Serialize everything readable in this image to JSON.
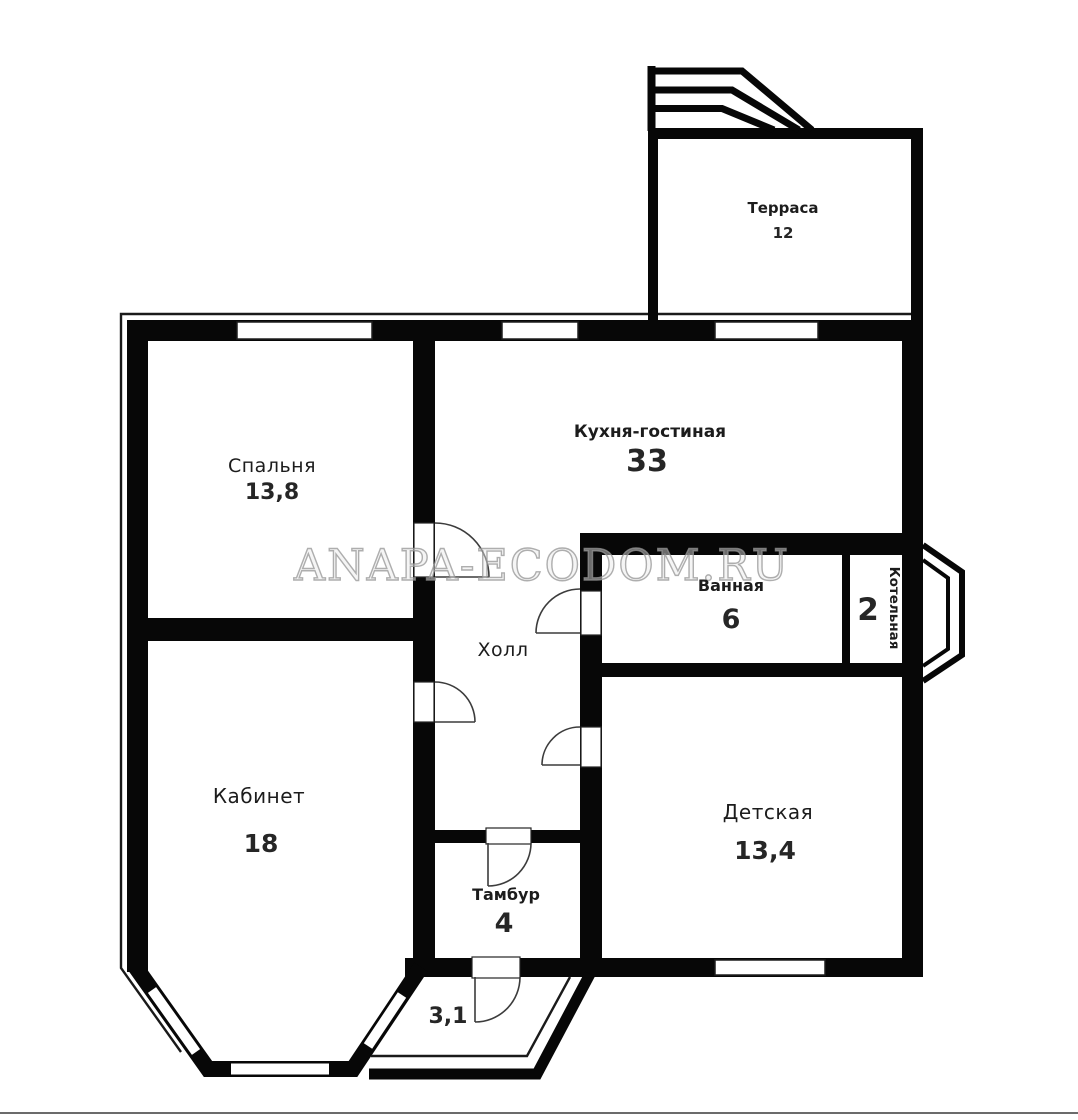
{
  "page": {
    "background": "#ffffff",
    "wall_color": "#070707",
    "watermark": "ANAPA-ECODOM.RU"
  },
  "rooms": {
    "terrace": {
      "name": "Терраса",
      "area": "12"
    },
    "bedroom": {
      "name": "Спальня",
      "area": "13,8"
    },
    "kitchen_living": {
      "name": "Кухня-гостиная",
      "area": "33"
    },
    "bathroom": {
      "name": "Ванная",
      "area": "6"
    },
    "boiler": {
      "name": "Котельная",
      "area": "2"
    },
    "hall": {
      "name": "Холл"
    },
    "office": {
      "name": "Кабинет",
      "area": "18"
    },
    "children": {
      "name": "Детская",
      "area": "13,4"
    },
    "vestibule": {
      "name": "Тамбур",
      "area": "4"
    },
    "porch": {
      "area": "3,1"
    }
  }
}
